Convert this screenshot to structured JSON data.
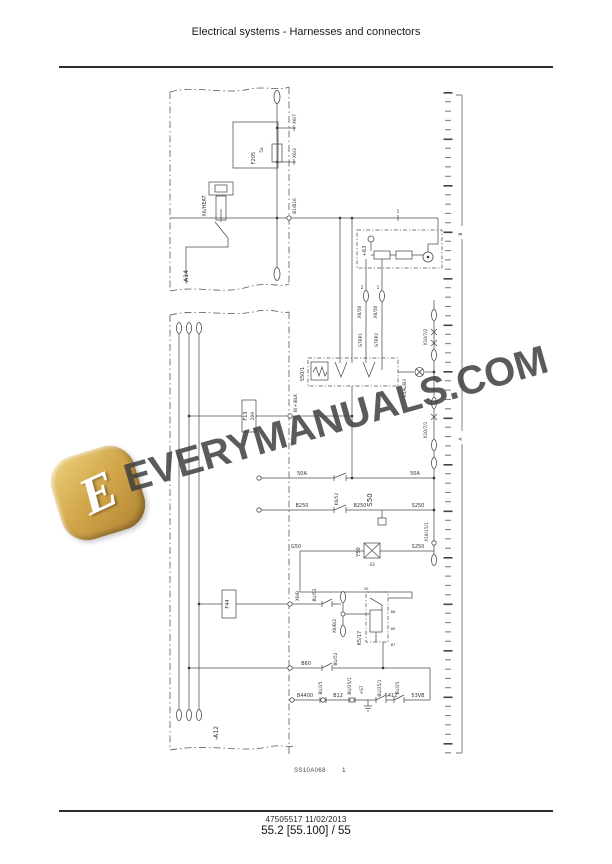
{
  "page": {
    "header": {
      "title": "Electrical systems - Harnesses and connectors"
    },
    "footer": {
      "doc_number": "47505517",
      "date": "11/02/2013",
      "page_ref": "55.2 [55.100] / 55"
    },
    "caption": {
      "code": "SS10A068",
      "figure_number": "1"
    }
  },
  "watermark": {
    "text": "EVERYMANUALS.COM",
    "logo_letter": "E",
    "logo_color": "#d4a94c",
    "text_color": "#3f3f3f"
  },
  "diagram": {
    "harnesses": {
      "top": "-A14",
      "main": "-A12"
    },
    "components": {
      "f205": "F205",
      "f205_rating": "5a",
      "x6_heat": "X6/HEAT",
      "plus63": "+63",
      "s50_1": "S50/1",
      "s50": "S50",
      "y50": "Y50",
      "f13": "F13",
      "f13_rating": "20A",
      "f44": "F44",
      "k5_17": "K5/17",
      "s412": "S412",
      "plus_s7": "+S7"
    },
    "connectors": {
      "x6_7": "X6/7",
      "x6_2": "X6/2",
      "b1_b16": "B1/B16",
      "x6_50": "X6/50",
      "x10_7_2": "X10/7/2",
      "x10_7_1": "X10/7/1",
      "x18_15_1": "X18/15/1",
      "x0_b": "X0/B",
      "x0_b_2": "X0/B/2"
    },
    "wires": {
      "gtrp1": "GTRP1",
      "gtrp2": "GTRP2",
      "e2al_b3": "E2AL/B3",
      "w50a": "50A",
      "b250": "B250",
      "s250": "S250",
      "k6_52": "K6/52",
      "g50": "G50",
      "b_plus_blk": "B(+)BLK",
      "bu52": "BU/52",
      "b60": "B60",
      "b4400": "B4400",
      "bu25": "BU/25",
      "b12": "B12",
      "bu25_1": "BU/25/1",
      "v53": "53VB"
    },
    "pins": {
      "p1": "1",
      "p2": "2",
      "p43": "43",
      "p85": "85",
      "p86": "86",
      "p30": "30",
      "p87": "87"
    },
    "ruler": {
      "bracket_label_b": "B",
      "bracket_label_a": "A"
    }
  }
}
